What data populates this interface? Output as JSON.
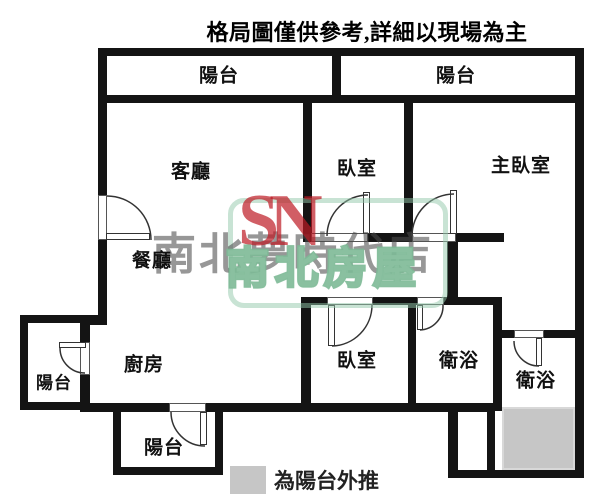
{
  "title": "格局圖僅供參考,詳細以現場為主",
  "rooms": [
    {
      "id": "balcony-top-left",
      "label": "陽台"
    },
    {
      "id": "balcony-top-right",
      "label": "陽台"
    },
    {
      "id": "living-room",
      "label": "客廳"
    },
    {
      "id": "bedroom-top",
      "label": "臥室"
    },
    {
      "id": "master-bedroom",
      "label": "主臥室"
    },
    {
      "id": "dining-room",
      "label": "餐廳"
    },
    {
      "id": "balcony-left",
      "label": "陽台"
    },
    {
      "id": "kitchen",
      "label": "廚房"
    },
    {
      "id": "bedroom-bottom",
      "label": "臥室"
    },
    {
      "id": "bathroom-1",
      "label": "衛浴"
    },
    {
      "id": "bathroom-2",
      "label": "衛浴"
    },
    {
      "id": "balcony-bottom",
      "label": "陽台"
    }
  ],
  "legend": {
    "label": "為陽台外推",
    "swatch_color": "#c6c6c6"
  },
  "colors": {
    "wall": "#141414",
    "pushed_area_fill": "#c6c6c6",
    "watermark_red": "rgba(190,25,35,0.70)",
    "watermark_gray": "rgba(75,75,75,0.58)",
    "watermark_green": "rgba(125,185,150,0.9)"
  },
  "watermark": {
    "logo": "SN",
    "store": "南北夢時代店",
    "brand": "南北房屋"
  }
}
